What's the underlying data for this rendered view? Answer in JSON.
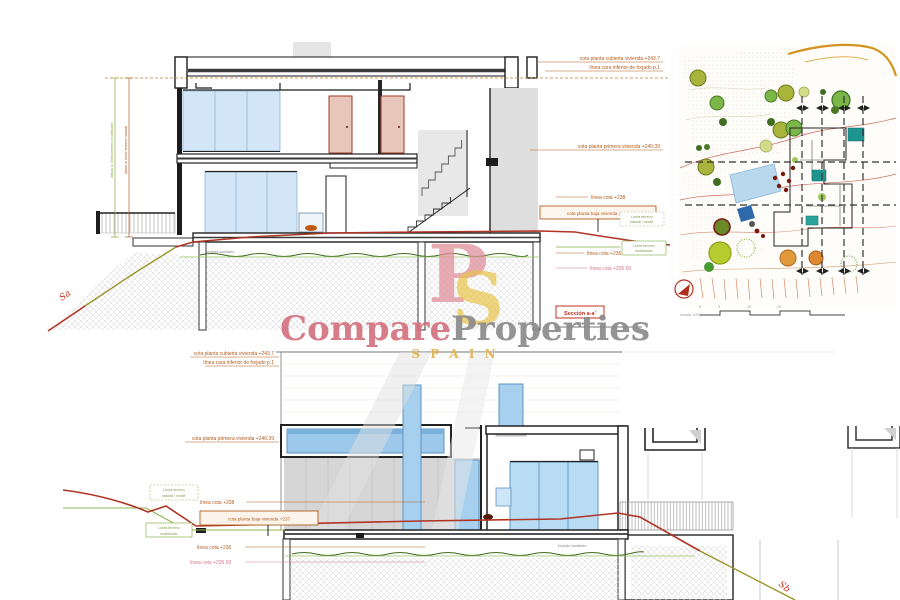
{
  "watermark": {
    "part1": "Compare",
    "part2": "Properties",
    "sub": "S P A I N",
    "mono_p": "P",
    "mono_s": "S"
  },
  "annotations": {
    "roof_level": "cota planta cubierta vivienda +243.7",
    "roof_soffit": "línea cara inferior de forjado p.1",
    "first_floor": "cota planta primera vivienda +240.39",
    "line_238": "línea cota +238",
    "ground_floor": "cota planta baja vivienda +237",
    "terrain_natural_l1": "Línea terreno",
    "terrain_natural_l2": "natural / modif.",
    "line_236": "línea cota +236",
    "terrain_modified_l1": "Línea terreno",
    "terrain_modified_l2": "modificado",
    "line_235_50": "línea cota +235.50",
    "crawl_space": "forjado sanitario",
    "height_green": "altura s/ línea terreno modificado",
    "height_red": "altura s/ línea terreno natural"
  },
  "section_a": {
    "label": "Sección a-a'",
    "slope_label": "Sa"
  },
  "section_b": {
    "slope_label": "Sb"
  },
  "site_plan": {
    "scale_label": "escala 1/200",
    "ticks": [
      "0",
      "5",
      "10",
      "20"
    ]
  }
}
